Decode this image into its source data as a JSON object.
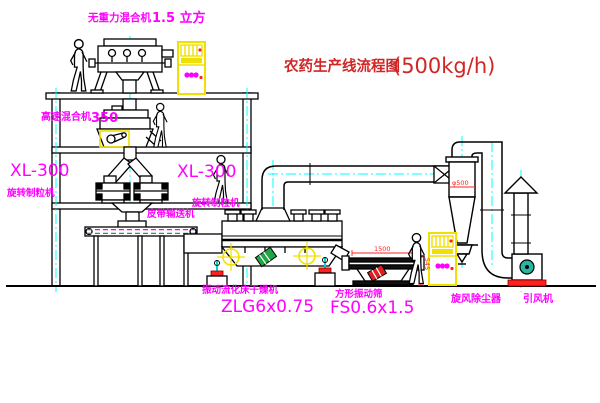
{
  "title": {
    "main": "农药生产线流程图",
    "capacity": "(500kg/h)"
  },
  "labels": {
    "gravity_mixer": {
      "name": "无重力混合机",
      "spec": "1.5 立方"
    },
    "high_speed_mixer": {
      "name": "高速混合机",
      "spec": "350"
    },
    "granulator_left": {
      "model": "XL-300",
      "name": "旋转制粒机"
    },
    "granulator_mid": {
      "model": "XL-300",
      "name": "旋转制粒机"
    },
    "belt_conveyor": "皮带输送机",
    "fluid_bed_dryer": {
      "name": "振动流化床干燥机",
      "model": "ZLG6x0.75"
    },
    "vibrating_screen": {
      "name": "方形振动筛",
      "model": "FS0.6x1.5"
    },
    "cyclone": "旋风除尘器",
    "fan": "引风机"
  },
  "dimensions": {
    "screen_length": "1500",
    "screen_height": "545",
    "cyclone_inlet": "φ500"
  },
  "colors": {
    "line": "#000000",
    "centerline": "#00ffff",
    "label_magenta": "#ff00ff",
    "title_red": "#d22626",
    "dimension_red": "#ff2222",
    "cabinet_yellow": "#f0e000",
    "alert_red": "#ff2020",
    "motor_green": "#21a447",
    "fan_teal": "#2ab5a0"
  }
}
